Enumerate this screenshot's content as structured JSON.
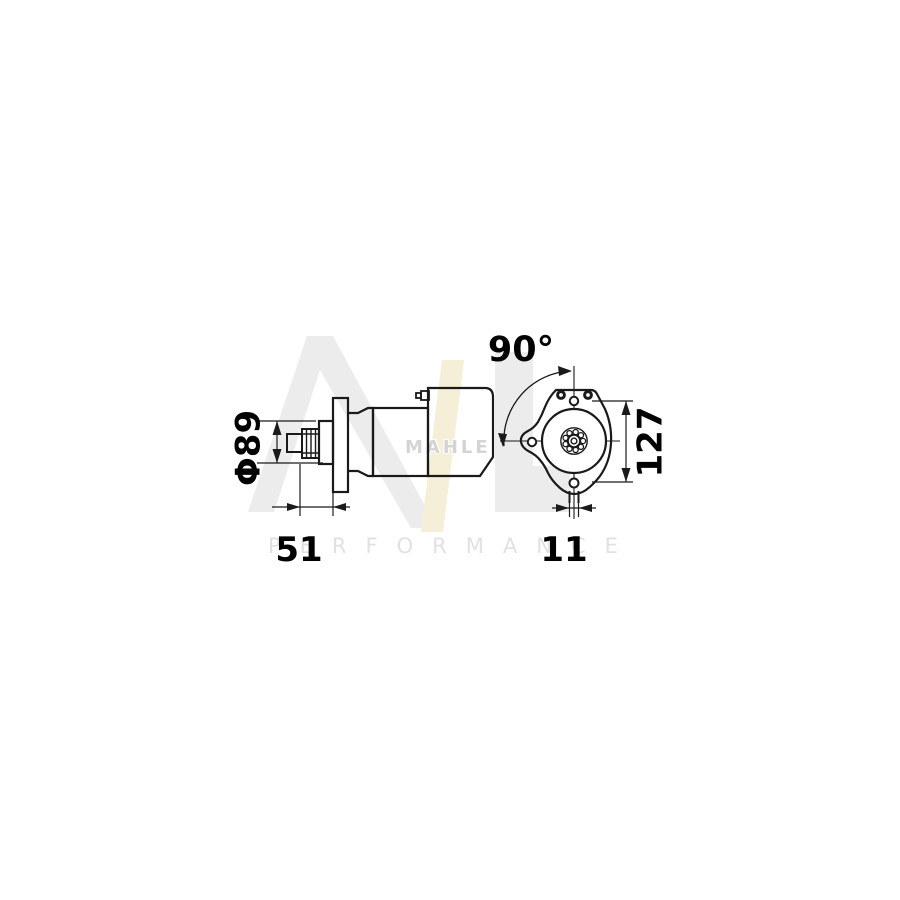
{
  "page": {
    "background": "#ffffff"
  },
  "watermark": {
    "brand_text": "MAHLE",
    "performance_text": "PERFORMANCE",
    "gray": "#ececec",
    "accent_yellow": "#f4efd6",
    "brand_text_color": "#d4d4d4",
    "performance_text_color": "#e1e1e1"
  },
  "drawing": {
    "line_color": "#1a1a1a",
    "subject": "starter-motor-technical-drawing",
    "dimensions": {
      "pinion_diameter": "Φ89",
      "pinion_length": "51",
      "rotation_angle": "90°",
      "mount_hole_spacing": "127",
      "tab_width": "11"
    }
  }
}
